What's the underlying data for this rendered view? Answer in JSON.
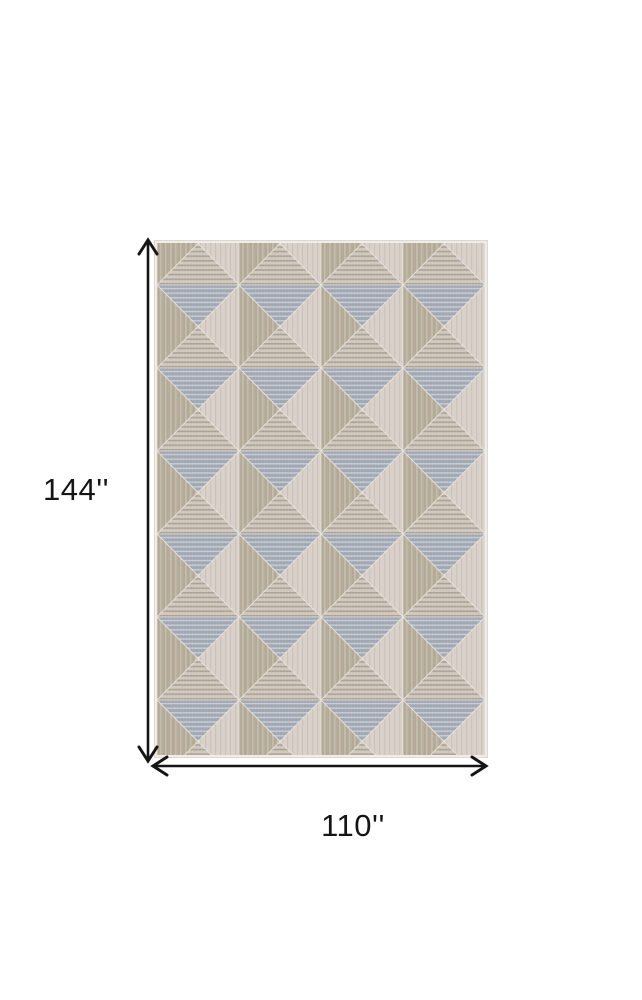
{
  "dimensions": {
    "height": "144''",
    "width": "110''"
  },
  "colors": {
    "background": "#ffffff",
    "annotation": "#151515",
    "rug_grey": "#a0a7b2",
    "rug_grey_stripe": "#c9cdd4",
    "rug_beige": "#b2a997",
    "rug_beige_stripe": "#c8c1b0",
    "rug_cream": "#d8d0c9",
    "rug_cream_stripe": "#cac1b8",
    "rug_tan_light": "#cfc8be",
    "rug_tan_dark": "#a9a194",
    "rug_groove": "#e9e4dd",
    "rug_edge": "#f0ede7"
  }
}
